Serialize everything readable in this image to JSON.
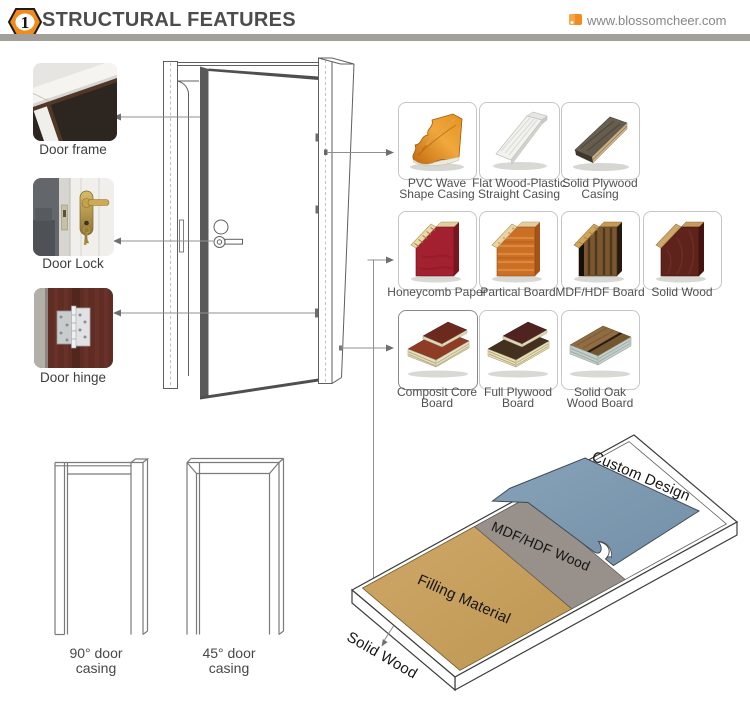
{
  "header": {
    "badge_number": "1",
    "title": "STRUCTURAL FEATURES",
    "website": "www.blossomcheer.com"
  },
  "left_items": [
    {
      "label": "Door frame"
    },
    {
      "label": "Door Lock"
    },
    {
      "label": "Door hinge"
    }
  ],
  "materials": {
    "casings_row": [
      {
        "line1": "PVC Wave",
        "line2": "Shape Casing"
      },
      {
        "line1": "Flat Wood-Plastic",
        "line2": "Straight Casing"
      },
      {
        "line1": "Solid Plywood",
        "line2": "Casing"
      }
    ],
    "cores_row": [
      {
        "label": "Honeycomb Paper"
      },
      {
        "label": "Partical Board"
      },
      {
        "label": "MDF/HDF Board"
      },
      {
        "label": "Solid Wood"
      }
    ],
    "boards_row": [
      {
        "line1": "Composit Core",
        "line2": "Board"
      },
      {
        "line1": "Full Plywood",
        "line2": "Board"
      },
      {
        "line1": "Solid Oak",
        "line2": "Wood Board"
      }
    ]
  },
  "casing_drawings": [
    {
      "line1": "90° door",
      "line2": "casing"
    },
    {
      "line1": "45° door",
      "line2": "casing"
    }
  ],
  "layer_diagram": {
    "layers": [
      {
        "label": "Custom Design",
        "color": "#7e9ab2"
      },
      {
        "label": "MDF/HDF Wood",
        "color": "#98908a"
      },
      {
        "label": "Filling Material",
        "color": "#c7a160"
      },
      {
        "label": "Solid Wood",
        "color": "#ffffff"
      }
    ]
  },
  "colors": {
    "accent_orange": "#f28b1e",
    "header_bar_gray": "#a3a09b",
    "title_gray": "#4c4c4c"
  }
}
